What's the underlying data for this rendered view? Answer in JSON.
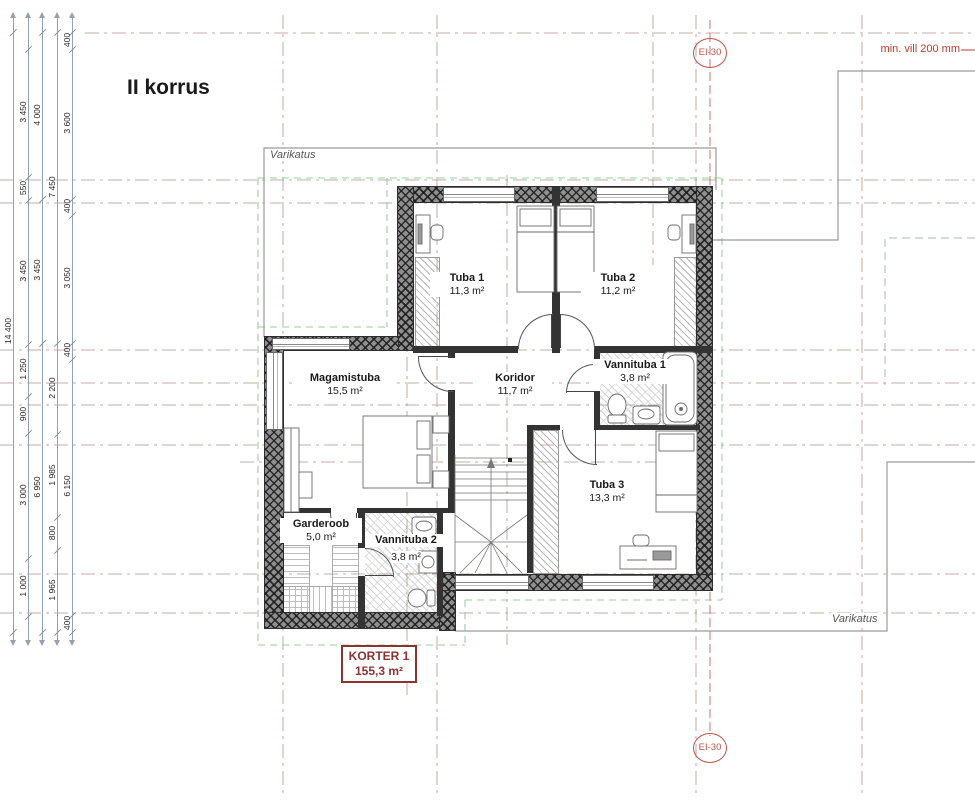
{
  "title": "II korrus",
  "plan": {
    "rooms": {
      "tuba1": {
        "name": "Tuba 1",
        "area": "11,3 m²"
      },
      "tuba2": {
        "name": "Tuba 2",
        "area": "11,2 m²"
      },
      "magamistuba": {
        "name": "Magamistuba",
        "area": "15,5 m²"
      },
      "koridor": {
        "name": "Koridor",
        "area": "11,7 m²"
      },
      "vannituba1": {
        "name": "Vannituba 1",
        "area": "3,8 m²"
      },
      "tuba3": {
        "name": "Tuba 3",
        "area": "13,3 m²"
      },
      "garderoob": {
        "name": "Garderoob",
        "area": "5,0 m²"
      },
      "vannituba2": {
        "name": "Vannituba 2",
        "area": "3,8 m²"
      }
    },
    "apartment": {
      "label": "KORTER 1",
      "area": "155,3 m²"
    },
    "annotations": {
      "canopy_top": "Varikatus",
      "canopy_bottom": "Varikatus",
      "insulation_note": "min. vill 200 mm",
      "fire_rating_top": "EI-30",
      "fire_rating_bottom": "EI-30"
    },
    "dimensions": {
      "chains": [
        {
          "labels": [
            "14 400"
          ]
        },
        {
          "labels": [
            "3 450",
            "550",
            "3 450",
            "1 250",
            "900",
            "3 000",
            "1 000"
          ]
        },
        {
          "labels": [
            "4 000",
            "3 450",
            "6 950"
          ]
        },
        {
          "labels": [
            "7 450",
            "2 200",
            "1 985",
            "800",
            "1 965"
          ]
        },
        {
          "labels": [
            "400",
            "3 600",
            "400",
            "3 050",
            "400",
            "6 150",
            "400"
          ]
        }
      ]
    },
    "colors": {
      "wall": "#4a4a4a",
      "gridline": "#b4948a",
      "boundary_green": "#97d097",
      "fire_red": "#c0544a",
      "apartment_red": "#8a3331",
      "dimension": "#93a2b2"
    }
  }
}
